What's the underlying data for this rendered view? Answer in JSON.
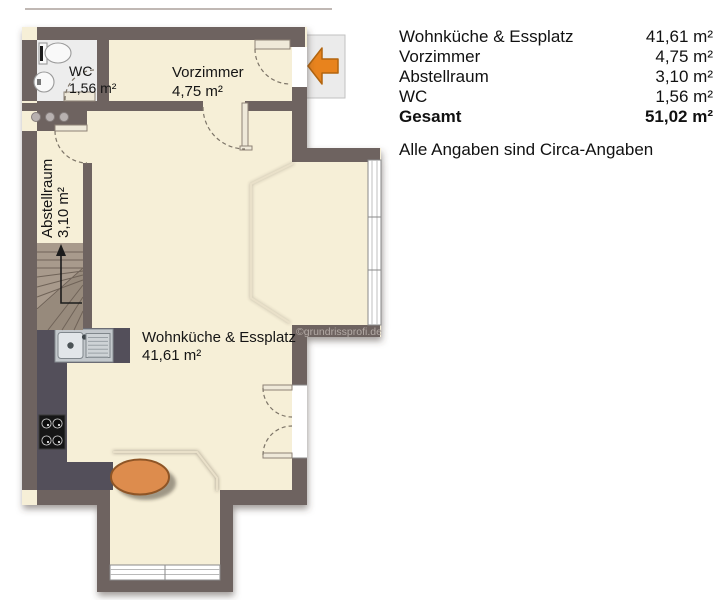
{
  "legend": {
    "rows": [
      {
        "label": "Wohnküche & Essplatz",
        "value": "41,61 m²"
      },
      {
        "label": "Vorzimmer",
        "value": "4,75 m²"
      },
      {
        "label": "Abstellraum",
        "value": "3,10 m²"
      },
      {
        "label": "WC",
        "value": "1,56 m²"
      },
      {
        "label": "Gesamt",
        "value": "51,02 m²"
      }
    ],
    "note": "Alle Angaben sind Circa-Angaben"
  },
  "rooms": {
    "wohnkueche": {
      "name": "Wohnküche & Essplatz",
      "area": "41,61 m²"
    },
    "vorzimmer": {
      "name": "Vorzimmer",
      "area": "4,75 m²"
    },
    "abstellraum": {
      "name": "Abstellraum",
      "area": "3,10 m²"
    },
    "wc": {
      "name": "WC",
      "area": "1,56 m²"
    }
  },
  "watermark": "©grundrissprofi.de",
  "colors": {
    "wall": "#6e6360",
    "floor": "#f6efd7",
    "counter": "#53505a",
    "stairs": "#a89a8c",
    "table": "#dd8c4d",
    "table_outline": "#8e5526",
    "arrow": "#e8831d",
    "wc_floor": "#ededed",
    "watermark": "#b3aaa5"
  }
}
